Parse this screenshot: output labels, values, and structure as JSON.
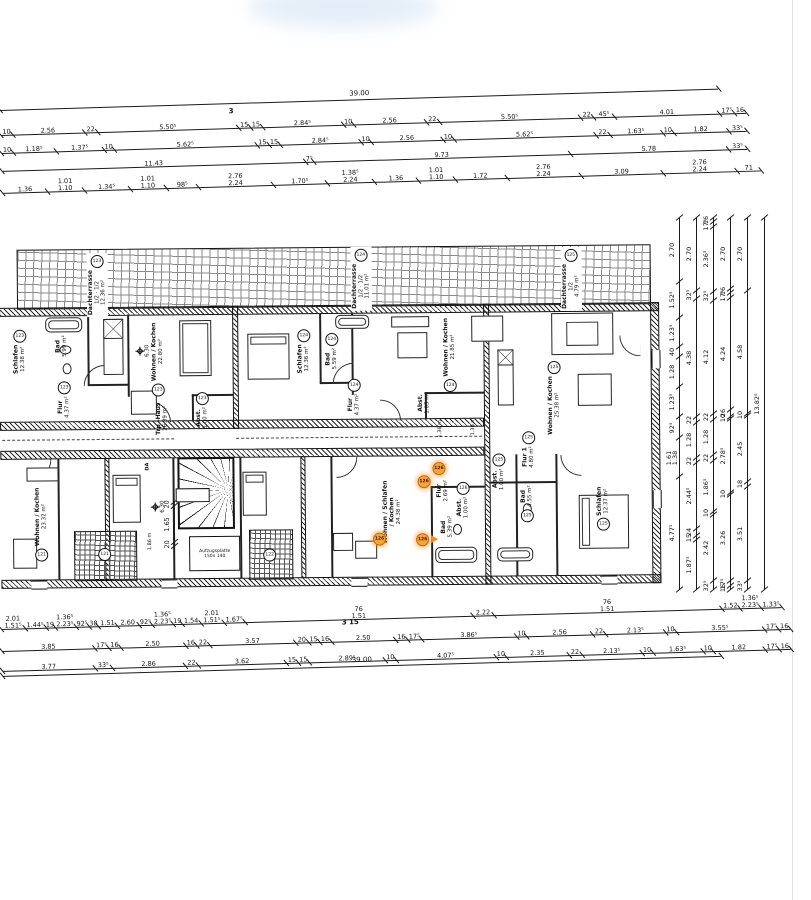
{
  "top_dims": {
    "total": "39.00",
    "top_mark": "3",
    "row_a": [
      "10",
      "2.56",
      "22",
      "5.50⁵",
      "15",
      "15",
      "2.84⁵",
      "10",
      "2.56",
      "22",
      "5.50⁵",
      "22",
      "45⁵",
      "4.01",
      "17⁵",
      "16"
    ],
    "row_b": [
      "10",
      "1.18⁵",
      "1.37⁵",
      "10",
      "5.62⁵",
      "15",
      "15",
      "2.84⁵",
      "10",
      "2.56",
      "10",
      "5.62⁵",
      "22",
      "1.63⁵",
      "10",
      "1.82",
      "33⁵"
    ],
    "row_c": [
      "11.43",
      "7⁵",
      "9.73",
      "5.78",
      "33⁵"
    ],
    "row_d": [
      "1.36",
      "1.01\n1.10",
      "1.34⁵",
      "1.01\n1.10",
      "98⁵",
      "2.76\n2.24",
      "1.70⁵",
      "1.38⁵\n2.24",
      "1.36",
      "1.01\n1.10",
      "1.72",
      "2.76\n2.24",
      "3.09",
      "2.76\n2.24",
      "71"
    ]
  },
  "bottom_dims": {
    "total": "39.00",
    "mark": "3  15",
    "row_1": [
      "2.01\n1.51⁵",
      "1.44⁵",
      "19",
      "1.36⁵\n2.23⁵",
      "92⁵",
      "38",
      "1.51",
      "2.60",
      "92⁵",
      "1.36⁵\n2.23⁵",
      "19",
      "1.54",
      "2.01\n1.51⁵",
      "1.67⁵",
      "76\n1.51",
      "2.22",
      "76\n1.51",
      "1.52",
      "1.36⁵\n2.23⁵",
      "1.33⁵"
    ],
    "row_2": [
      "3.85",
      "17⁵",
      "16",
      "2.50",
      "16",
      "22",
      "3.57",
      "20",
      "15",
      "16",
      "2.50",
      "16",
      "17⁵",
      "3.86⁵",
      "10",
      "2.56",
      "22",
      "2.13⁵",
      "10",
      "3.55⁵",
      "17⁵",
      "16"
    ],
    "row_3": [
      "3.77",
      "33⁵",
      "2.86",
      "22",
      "3.62",
      "15",
      "15",
      "2.89⁵",
      "10",
      "4.07⁵",
      "10",
      "2.35",
      "22",
      "2.13⁵",
      "10",
      "1.63⁵",
      "10",
      "1.82",
      "17⁵",
      "16"
    ]
  },
  "right_dims": {
    "c1": [
      "2.70",
      "1.52⁵",
      "1.23⁵",
      "40",
      "1.28",
      "1.23⁵",
      "92⁵",
      "1.61\n1.38",
      "4.77⁵"
    ],
    "c2": [
      "2.70",
      "32⁵",
      "4.38",
      "22",
      "1.28",
      "22",
      "2.44⁵",
      "24",
      "15",
      "1.87⁵"
    ],
    "c3": [
      "16",
      "17⁵",
      "2.36⁵",
      "32⁵",
      "4.12",
      "22",
      "1.28",
      "22",
      "1.86⁵",
      "10",
      "2.42",
      "32⁵"
    ],
    "c4": [
      "2.70",
      "16",
      "17⁵",
      "4.24",
      "26",
      "10",
      "2.78⁵",
      "10",
      "3.26",
      "17⁵",
      "16"
    ],
    "c5": [
      "2.70",
      "4.58",
      "10",
      "2.45",
      "18",
      "3.51",
      "33⁵"
    ],
    "c6": [
      "13.82⁵"
    ]
  },
  "plan": {
    "highlight_unit": "126",
    "highlight_color": "#f7a33b",
    "level_marks": [
      "6.30",
      "6.30"
    ],
    "stair": {
      "name": "Trp.-Haus",
      "area": "26.39 m²",
      "da": "DA",
      "lift": "Aufzugsplatte",
      "lift_size": "150x 140"
    },
    "stair_dims": [
      "20",
      "1.65",
      "20"
    ],
    "misc_dims": [
      "1.36 m",
      "1.36 m",
      "1.86 m"
    ],
    "loggia_units": [
      "121",
      "122"
    ],
    "terraces": [
      {
        "unit": "123",
        "name": "Dachterrasse",
        "detail": "1/2 · 1/2",
        "area": "12.36 m²"
      },
      {
        "unit": "124",
        "name": "Dachterrasse",
        "detail": "1/2 · 1/2",
        "area": "11.01 m²"
      },
      {
        "unit": "125",
        "name": "Dachterrasse",
        "detail": "1/2",
        "area": "4.79 m²"
      }
    ],
    "upper_rooms": [
      {
        "unit": "123",
        "name": "Schlafen",
        "area": "12.38 m²"
      },
      {
        "unit": "",
        "name": "Bad",
        "area": "5.99 m²"
      },
      {
        "unit": "123",
        "name": "Flur",
        "area": "4.37 m²"
      },
      {
        "unit": "123",
        "name": "Wohnen / Kochen",
        "area": "22.80 m²"
      },
      {
        "unit": "123",
        "name": "Abst.",
        "area": "1.00 m²"
      },
      {
        "unit": "124",
        "name": "Schlafen",
        "area": "12.36 m²"
      },
      {
        "unit": "124",
        "name": "Bad",
        "area": "5.59 m²"
      },
      {
        "unit": "124",
        "name": "Flur",
        "area": "4.37 m²"
      },
      {
        "unit": "124",
        "name": "Wohnen / Kochen",
        "area": "21.85 m²"
      },
      {
        "unit": "",
        "name": "Abst.",
        "area": "1.03 m²"
      },
      {
        "unit": "125",
        "name": "Wohnen / Kochen",
        "area": "25.38 m²"
      }
    ],
    "lower_rooms": [
      {
        "unit": "121",
        "name": "Wohnen / Kochen",
        "area": "23.32 m²"
      },
      {
        "unit": "126",
        "name": "Wohnen / Schlafen\n/ Kochen",
        "area": "24.38 m²"
      },
      {
        "unit": "126",
        "name": "Flur",
        "area": "2.69 m²"
      },
      {
        "unit": "126",
        "name": "Abst.",
        "area": "1.00 m²"
      },
      {
        "unit": "",
        "name": "Bad",
        "area": "5.39 m²"
      },
      {
        "unit": "125",
        "name": "Flur 1",
        "area": "4.80 m²"
      },
      {
        "unit": "125",
        "name": "Abst.",
        "area": "1.00 m²"
      },
      {
        "unit": "125",
        "name": "Bad",
        "area": "4.55 m²"
      },
      {
        "unit": "125",
        "name": "Schlafen",
        "area": "12.37 m²"
      }
    ]
  }
}
